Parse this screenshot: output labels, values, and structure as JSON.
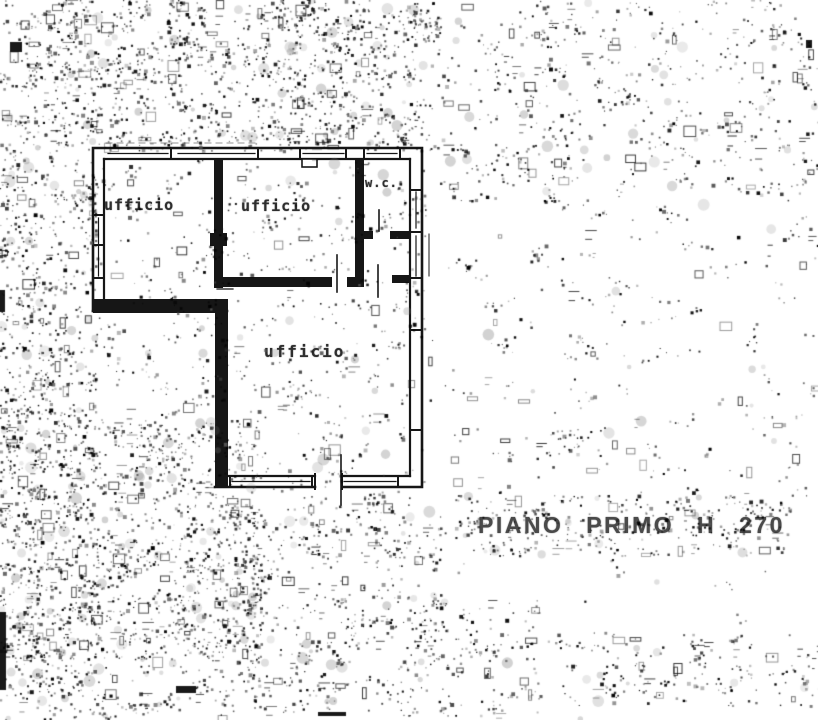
{
  "page": {
    "background_color": "#ffffff",
    "ink_color": "#1b1b1b",
    "label_color": "#2e2e2e",
    "caption_color": "#4a4a4a"
  },
  "floor_plan": {
    "rooms": [
      {
        "id": "office-left",
        "label": "ufficio"
      },
      {
        "id": "office-mid",
        "label": "ufficio"
      },
      {
        "id": "office-lower",
        "label": "ufficio"
      },
      {
        "id": "wc",
        "label": "w.c."
      }
    ],
    "caption": "PIANO PRIMO H 270"
  }
}
